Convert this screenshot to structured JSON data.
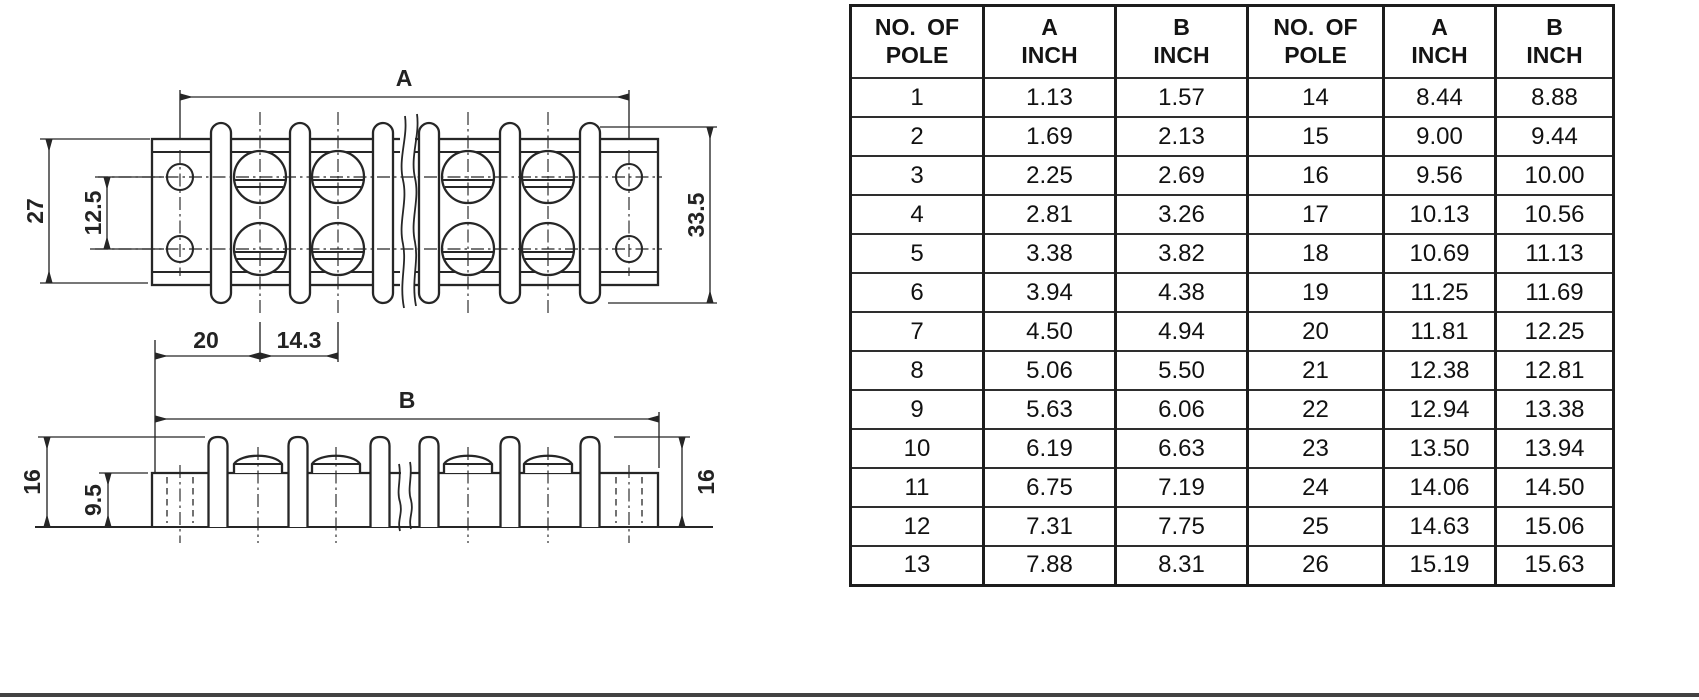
{
  "colors": {
    "line": "#262626",
    "table_border": "#1c1c1c",
    "bottom_bar": "#424242",
    "background": "#ffffff"
  },
  "drawing": {
    "top_view": {
      "label_a": "A",
      "label_27": "27",
      "label_12_5": "12.5",
      "label_33_5": "33.5",
      "label_20": "20",
      "label_14_3": "14.3"
    },
    "side_view": {
      "label_b": "B",
      "label_16_left": "16",
      "label_9_5": "9.5",
      "label_16_right": "16"
    }
  },
  "table": {
    "headers": [
      [
        "NO. OF",
        "POLE"
      ],
      [
        "A",
        "INCH"
      ],
      [
        "B",
        "INCH"
      ],
      [
        "NO. OF",
        "POLE"
      ],
      [
        "A",
        "INCH"
      ],
      [
        "B",
        "INCH"
      ]
    ],
    "rows": [
      [
        "1",
        "1.13",
        "1.57",
        "14",
        "8.44",
        "8.88"
      ],
      [
        "2",
        "1.69",
        "2.13",
        "15",
        "9.00",
        "9.44"
      ],
      [
        "3",
        "2.25",
        "2.69",
        "16",
        "9.56",
        "10.00"
      ],
      [
        "4",
        "2.81",
        "3.26",
        "17",
        "10.13",
        "10.56"
      ],
      [
        "5",
        "3.38",
        "3.82",
        "18",
        "10.69",
        "11.13"
      ],
      [
        "6",
        "3.94",
        "4.38",
        "19",
        "11.25",
        "11.69"
      ],
      [
        "7",
        "4.50",
        "4.94",
        "20",
        "11.81",
        "12.25"
      ],
      [
        "8",
        "5.06",
        "5.50",
        "21",
        "12.38",
        "12.81"
      ],
      [
        "9",
        "5.63",
        "6.06",
        "22",
        "12.94",
        "13.38"
      ],
      [
        "10",
        "6.19",
        "6.63",
        "23",
        "13.50",
        "13.94"
      ],
      [
        "11",
        "6.75",
        "7.19",
        "24",
        "14.06",
        "14.50"
      ],
      [
        "12",
        "7.31",
        "7.75",
        "25",
        "14.63",
        "15.06"
      ],
      [
        "13",
        "7.88",
        "8.31",
        "26",
        "15.19",
        "15.63"
      ]
    ]
  }
}
